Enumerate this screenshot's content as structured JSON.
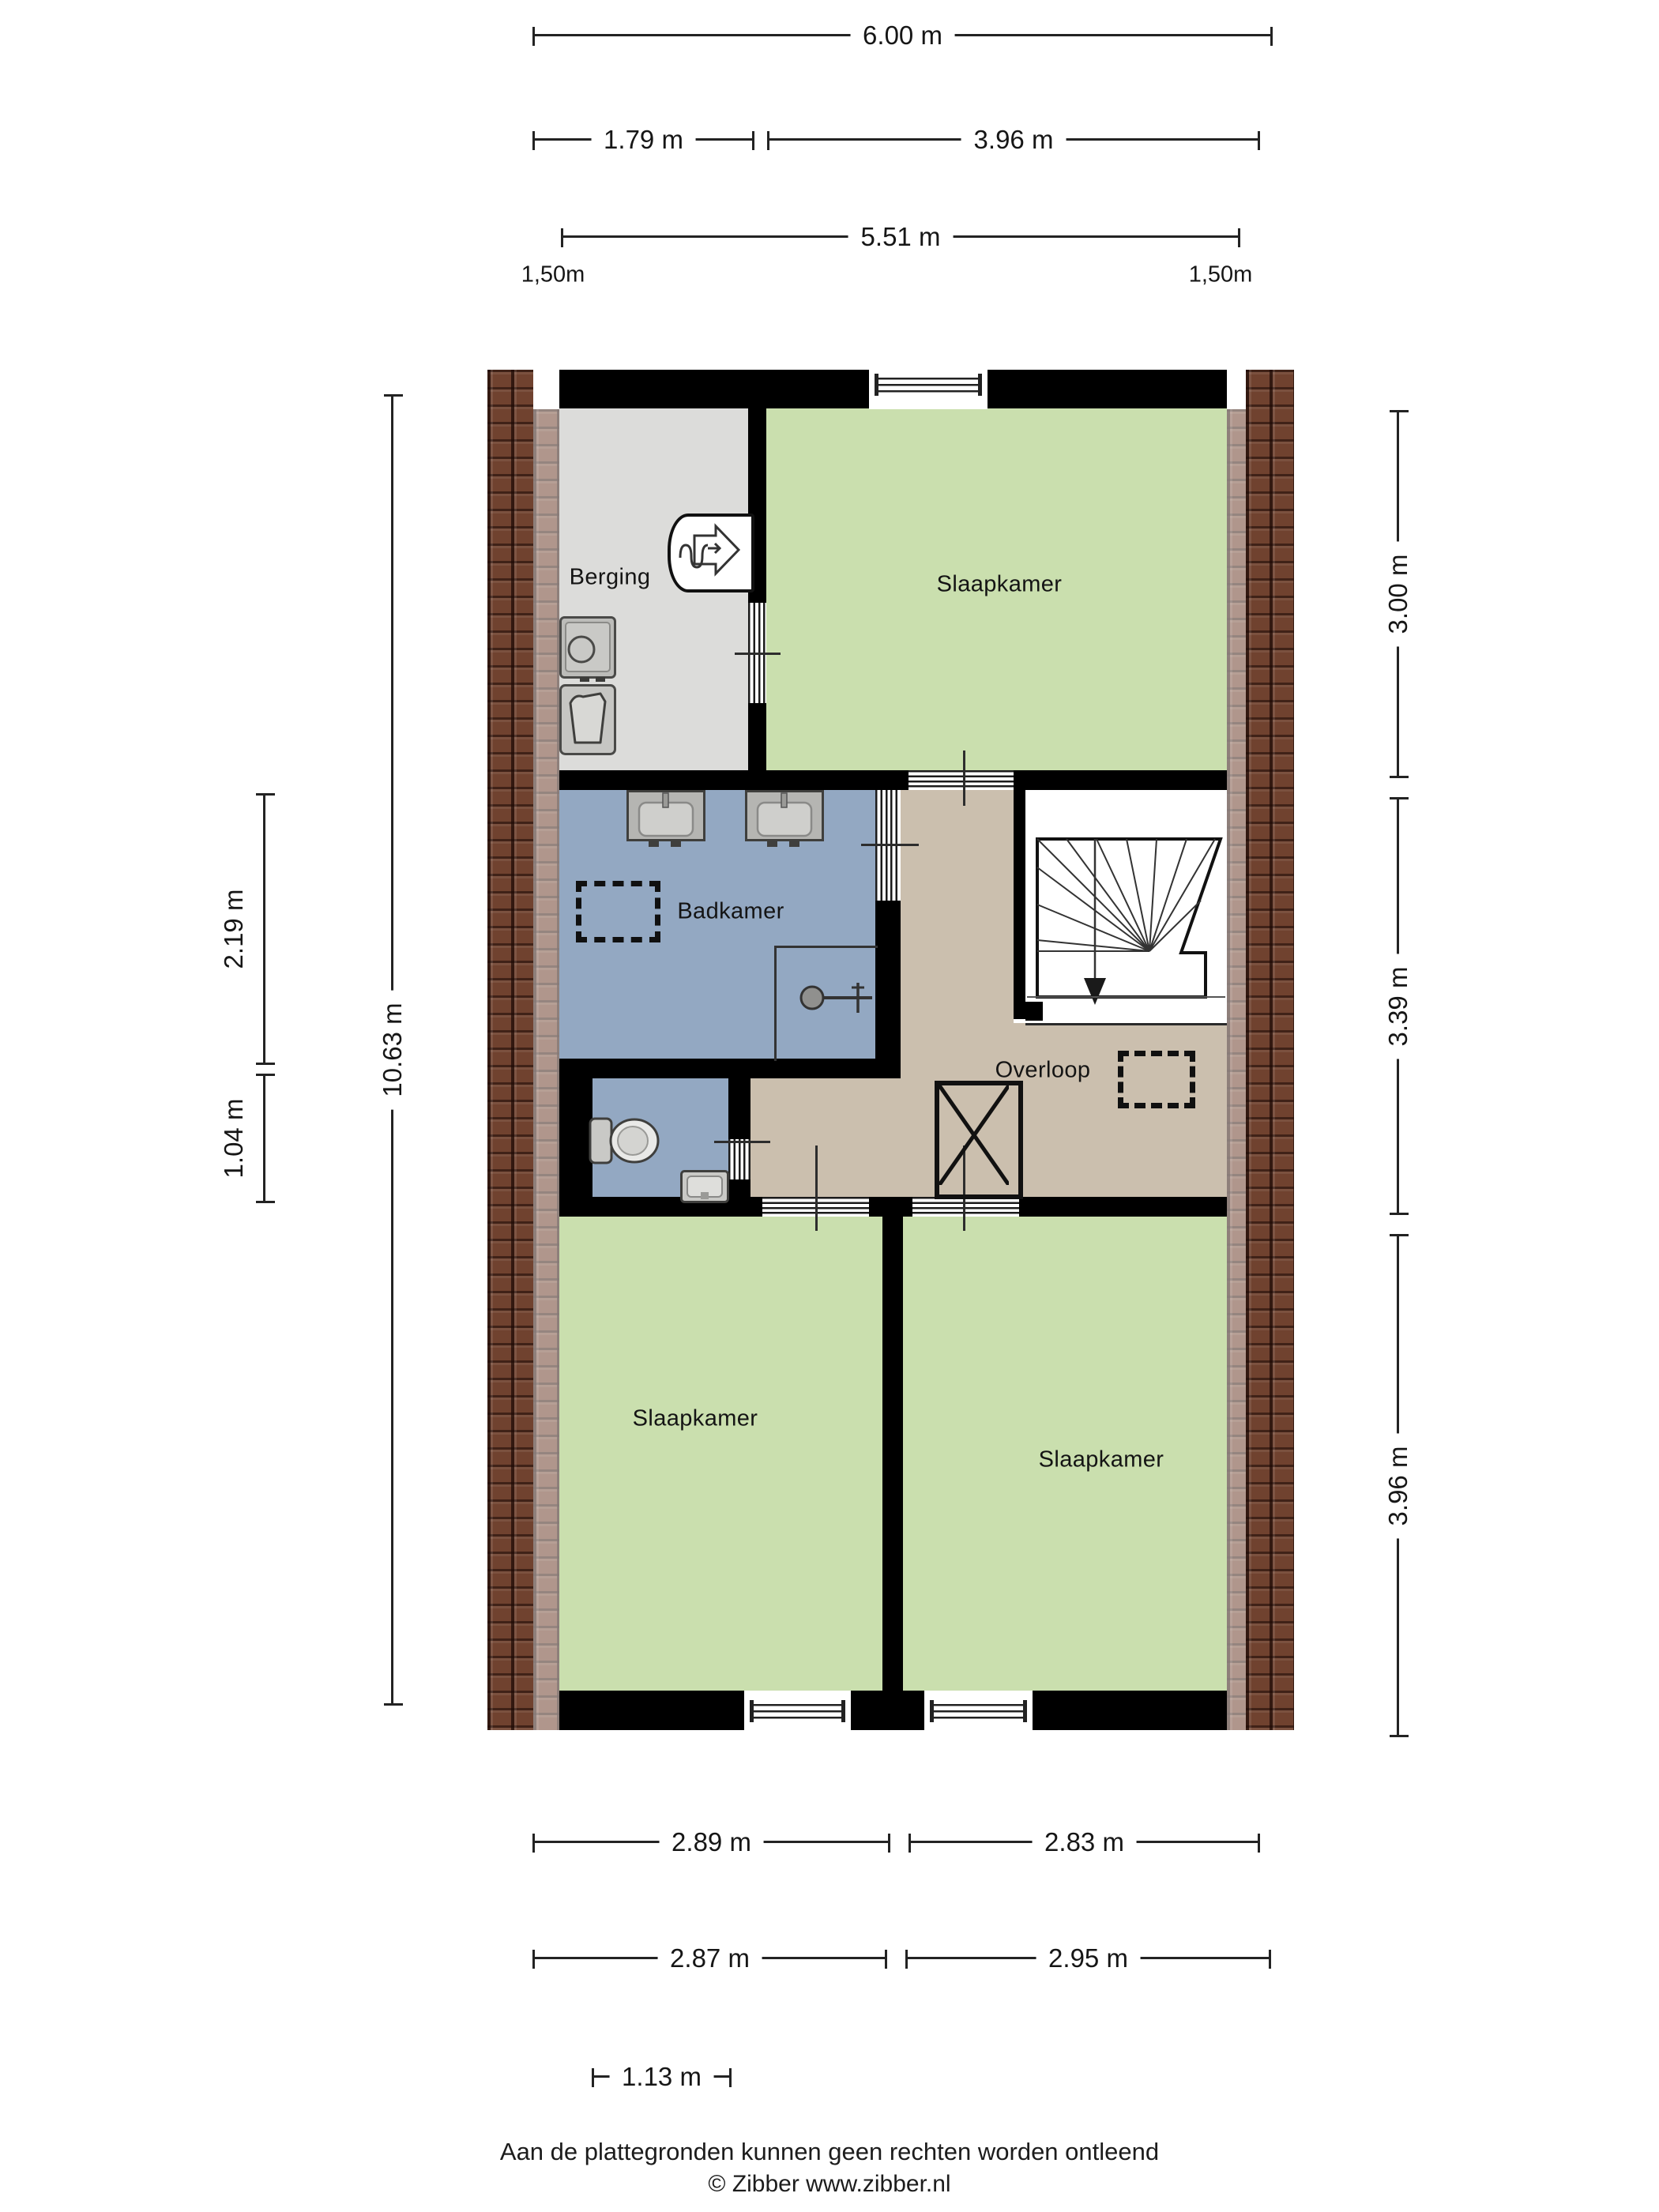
{
  "rooms": {
    "berging": "Berging",
    "slaapkamer_top": "Slaapkamer",
    "badkamer": "Badkamer",
    "overloop": "Overloop",
    "slaapkamer_left": "Slaapkamer",
    "slaapkamer_right": "Slaapkamer"
  },
  "dimensions": {
    "top_total_width": "6.00 m",
    "top_berging_width": "1.79 m",
    "top_slaapkamer_width": "3.96 m",
    "top_inner_width": "5.51 m",
    "knee_height_left": "1,50m",
    "knee_height_right": "1,50m",
    "left_total_height": "10.63 m",
    "left_badkamer_height": "2.19 m",
    "left_toilet_height": "1.04 m",
    "right_top_room_height": "3.00 m",
    "right_middle_height": "3.39 m",
    "right_bottom_rooms_height": "3.96 m",
    "bottom_left_room_width_a": "2.89 m",
    "bottom_right_room_width_a": "2.83 m",
    "bottom_left_room_width_b": "2.87 m",
    "bottom_right_room_width_b": "2.95 m",
    "bottom_offset": "1.13 m"
  },
  "footer": {
    "disclaimer": "Aan de plattegronden kunnen geen rechten worden ontleend",
    "copyright": "© Zibber www.zibber.nl"
  },
  "colors": {
    "bedroom": "#cadfae",
    "storage": "#dcdcda",
    "bathroom": "#93a8c2",
    "hall": "#cbbfae",
    "wall": "#000000",
    "brick_base": "#70422f",
    "line": "#1a1a1a"
  }
}
